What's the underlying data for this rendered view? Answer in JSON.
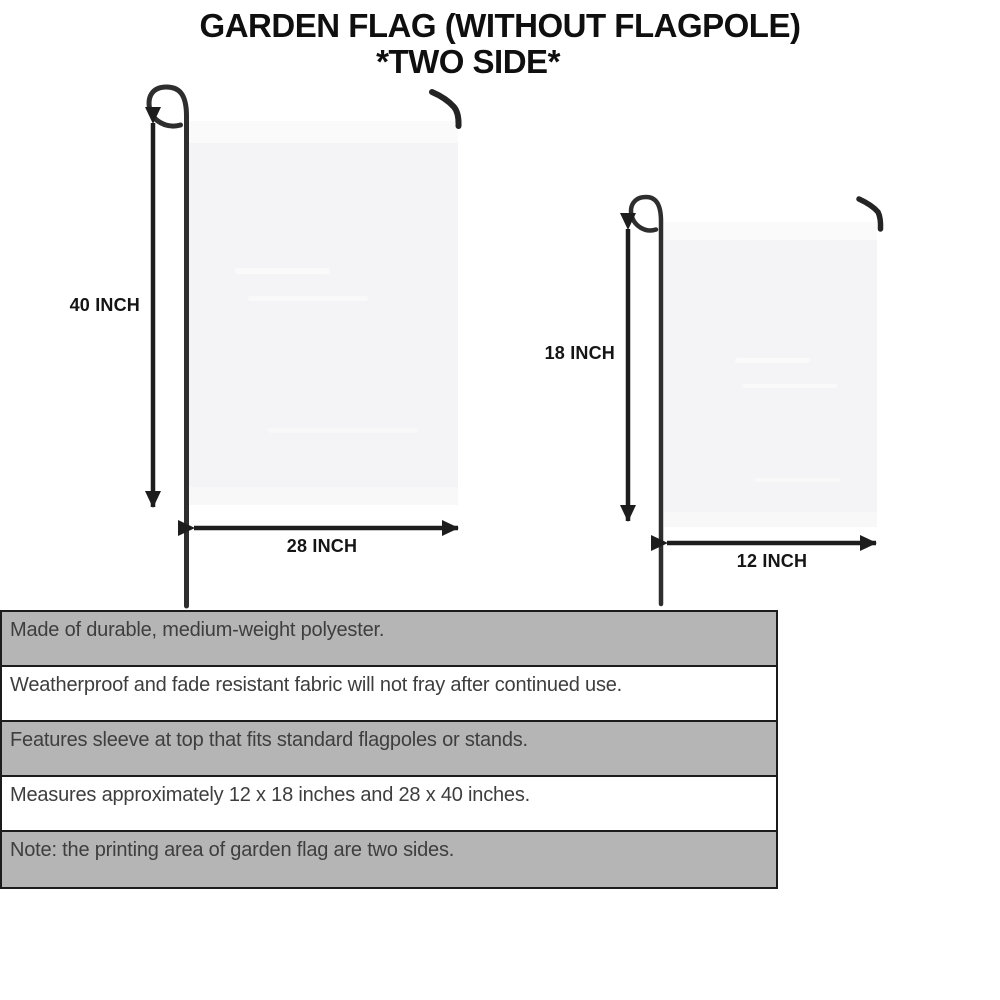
{
  "title": {
    "line1": "GARDEN FLAG (WITHOUT FLAGPOLE)",
    "line2": "*TWO SIDE*"
  },
  "diagram": {
    "large_flag": {
      "height_label": "40 INCH",
      "width_label": "28 INCH"
    },
    "small_flag": {
      "height_label": "18 INCH",
      "width_label": "12 INCH"
    }
  },
  "features": [
    "Made of durable, medium-weight polyester.",
    "Weatherproof and fade resistant fabric will not fray after continued use.",
    "Features sleeve at top that fits standard flagpoles or stands.",
    "Measures approximately 12 x 18 inches and 28 x 40 inches.",
    "Note: the printing area of garden flag are two sides."
  ],
  "colors": {
    "row_gray": "#b5b5b5",
    "row_white": "#ffffff",
    "table_border": "#1c1c1c",
    "flag_fill": "#f4f4f6",
    "pole": "#2e2e2e",
    "arrow": "#1d1d1d",
    "title_ink": "#0f0f0f",
    "body_text": "#3e3e3e"
  }
}
